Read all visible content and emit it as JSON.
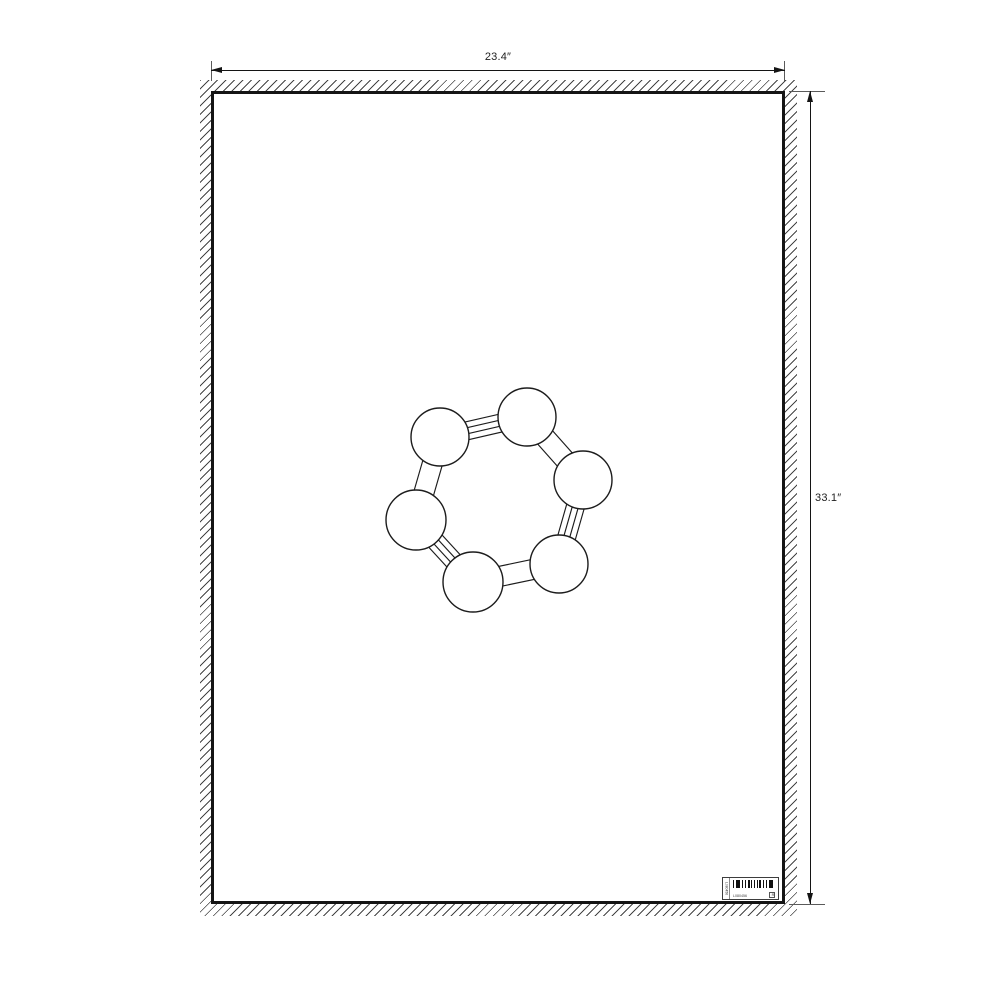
{
  "page": {
    "background": "#ffffff"
  },
  "dimensions": {
    "width_label": "23.4″",
    "height_label": "33.1″",
    "width_in": 23.4,
    "height_in": 33.1
  },
  "artwork": {
    "type": "molecule-ring",
    "stroke_color": "#1c1c1c",
    "atoms": [
      {
        "id": "A",
        "cx": 440,
        "cy": 437,
        "r": 29
      },
      {
        "id": "B",
        "cx": 527,
        "cy": 417,
        "r": 29
      },
      {
        "id": "C",
        "cx": 583,
        "cy": 480,
        "r": 29
      },
      {
        "id": "D",
        "cx": 559,
        "cy": 564,
        "r": 29
      },
      {
        "id": "E",
        "cx": 473,
        "cy": 582,
        "r": 30
      },
      {
        "id": "F",
        "cx": 416,
        "cy": 520,
        "r": 30
      }
    ],
    "bonds": [
      {
        "from": "A",
        "to": "B",
        "type": "quad"
      },
      {
        "from": "B",
        "to": "C",
        "type": "band"
      },
      {
        "from": "C",
        "to": "D",
        "type": "quad"
      },
      {
        "from": "D",
        "to": "E",
        "type": "band"
      },
      {
        "from": "E",
        "to": "F",
        "type": "quad"
      },
      {
        "from": "F",
        "to": "A",
        "type": "band"
      }
    ]
  },
  "barcode_label": {
    "code_text": "L080456",
    "side_text": "L080456",
    "box_glyph": "R"
  },
  "colors": {
    "line": "#141414",
    "hatch": "#454545"
  }
}
